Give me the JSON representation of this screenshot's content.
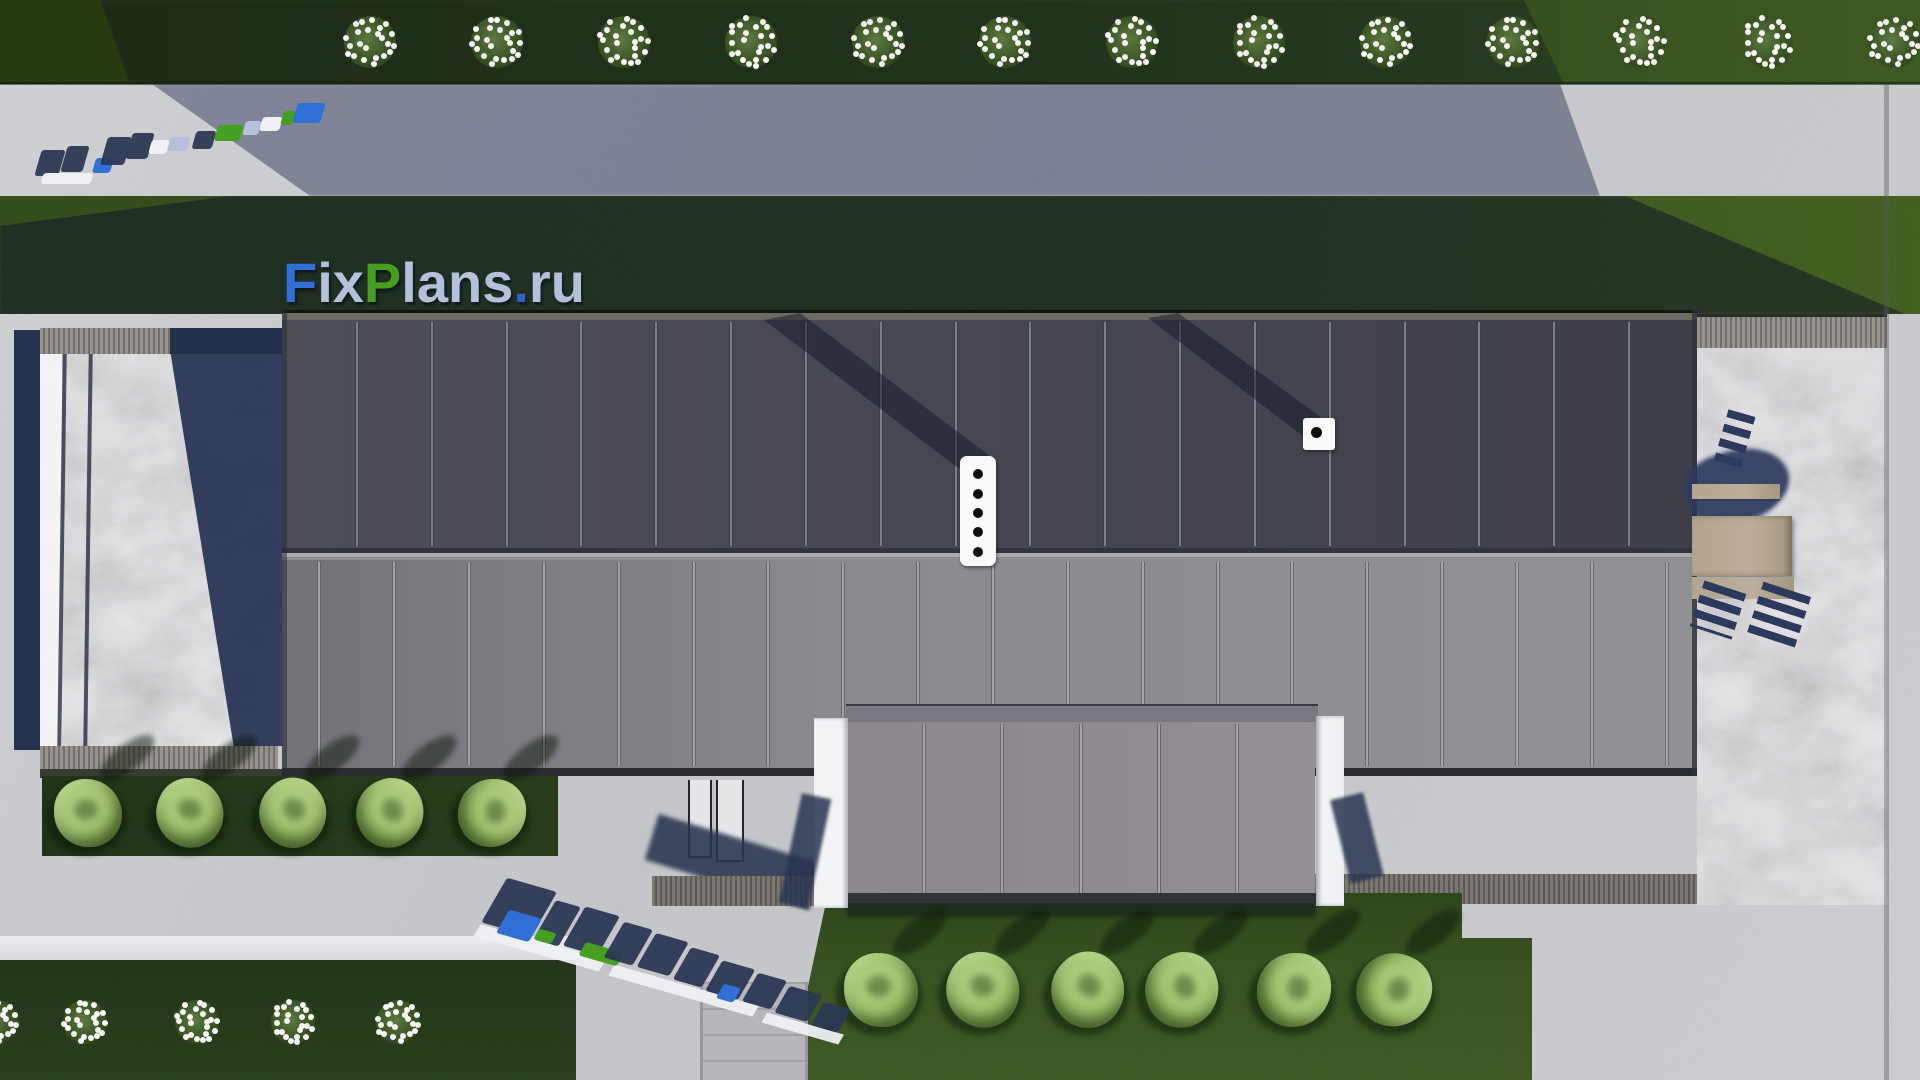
{
  "scene": {
    "description": "top-down architectural site render",
    "watermark_text": "FixPlans.ru"
  },
  "palette": {
    "pavement": "#cbccd0",
    "pavement_shadow": "rgba(52,60,94,0.5)",
    "grass_top": "#2e4418",
    "grass_field": "#3c5522",
    "grass_mid": "#35511f",
    "grass_dark_strip": "#24371a",
    "shadow_overlay": "rgba(16,22,38,0.52)",
    "roof_upper": "#45464f",
    "roof_lower": "#85848a",
    "roof_wing": "#8d898e",
    "white_wall": "#f3f4f6",
    "marble": "#e9e9ec",
    "navy": "#2c3854",
    "wood_band": "#6e6a66",
    "furniture_tan": "#b5a791",
    "flower_white": "#f6f7f5",
    "tree_foliage": "#a9c77c",
    "wm_blue": "#2f6fd6",
    "wm_green": "#45a021",
    "wm_pale": "#b6c0da",
    "wm_navy": "#2c3854",
    "wm_white": "#eef0f4"
  },
  "watermarks": {
    "main": {
      "full_text": "FixPlans.ru",
      "parts": [
        {
          "t": "F",
          "c": "#2f6fd6"
        },
        {
          "t": "ix",
          "c": "#b6c0da"
        },
        {
          "t": "P",
          "c": "#45a021"
        },
        {
          "t": "lans",
          "c": "#b6c0da"
        },
        {
          "t": ".",
          "c": "#2d62cc"
        },
        {
          "t": "ru",
          "c": "#b6c0da"
        }
      ]
    },
    "ground_top_left": {
      "text": "FixPlans.ru",
      "style": "flattened-perspective-blocks",
      "blocks": [
        {
          "x": 10,
          "y": 55,
          "w": 24,
          "h": 26,
          "c": "navy"
        },
        {
          "x": 36,
          "y": 51,
          "w": 22,
          "h": 26,
          "c": "navy"
        },
        {
          "x": 14,
          "y": 78,
          "w": 50,
          "h": 11,
          "c": "white"
        },
        {
          "x": 66,
          "y": 63,
          "w": 18,
          "h": 15,
          "c": "blue"
        },
        {
          "x": 76,
          "y": 42,
          "w": 24,
          "h": 28,
          "c": "navy"
        },
        {
          "x": 101,
          "y": 38,
          "w": 22,
          "h": 26,
          "c": "navy"
        },
        {
          "x": 122,
          "y": 45,
          "w": 18,
          "h": 14,
          "c": "white"
        },
        {
          "x": 141,
          "y": 42,
          "w": 20,
          "h": 14,
          "c": "pale"
        },
        {
          "x": 166,
          "y": 36,
          "w": 20,
          "h": 18,
          "c": "navy"
        },
        {
          "x": 188,
          "y": 30,
          "w": 26,
          "h": 16,
          "c": "green"
        },
        {
          "x": 216,
          "y": 26,
          "w": 16,
          "h": 14,
          "c": "pale"
        },
        {
          "x": 233,
          "y": 22,
          "w": 20,
          "h": 14,
          "c": "white"
        },
        {
          "x": 254,
          "y": 16,
          "w": 12,
          "h": 14,
          "c": "green"
        },
        {
          "x": 267,
          "y": 8,
          "w": 28,
          "h": 20,
          "c": "blue"
        }
      ]
    },
    "ground_bottom": {
      "text": "FixPlans.ru",
      "style": "flattened-perspective-blocks",
      "rotation_deg": 16,
      "blocks": [
        {
          "x": 8,
          "y": 6,
          "w": 52,
          "h": 50,
          "c": "navy"
        },
        {
          "x": 62,
          "y": 14,
          "w": 26,
          "h": 44,
          "c": "navy"
        },
        {
          "x": 22,
          "y": 36,
          "w": 34,
          "h": 26,
          "c": "blue"
        },
        {
          "x": 58,
          "y": 46,
          "w": 18,
          "h": 12,
          "c": "green"
        },
        {
          "x": 92,
          "y": 12,
          "w": 36,
          "h": 44,
          "c": "navy"
        },
        {
          "x": 106,
          "y": 46,
          "w": 40,
          "h": 15,
          "c": "green"
        },
        {
          "x": 134,
          "y": 16,
          "w": 30,
          "h": 40,
          "c": "navy"
        },
        {
          "x": 168,
          "y": 18,
          "w": 34,
          "h": 38,
          "c": "navy"
        },
        {
          "x": 206,
          "y": 22,
          "w": 30,
          "h": 36,
          "c": "navy"
        },
        {
          "x": 240,
          "y": 26,
          "w": 34,
          "h": 34,
          "c": "navy"
        },
        {
          "x": 250,
          "y": 48,
          "w": 18,
          "h": 16,
          "c": "blue"
        },
        {
          "x": 278,
          "y": 28,
          "w": 30,
          "h": 32,
          "c": "navy"
        },
        {
          "x": 312,
          "y": 32,
          "w": 34,
          "h": 30,
          "c": "navy"
        },
        {
          "x": 350,
          "y": 38,
          "w": 28,
          "h": 26,
          "c": "navy"
        }
      ],
      "white_bands": [
        {
          "x": 0,
          "y": 58,
          "w": 130,
          "h": 13
        },
        {
          "x": 140,
          "y": 60,
          "w": 150,
          "h": 12
        },
        {
          "x": 300,
          "y": 64,
          "w": 80,
          "h": 11
        }
      ]
    }
  },
  "building": {
    "upper_roof_panels": 19,
    "lower_roof_panels": 19,
    "wing_panels": 6,
    "chimney": {
      "vent_holes": 5,
      "holes_y": [
        474,
        494,
        513,
        532,
        552
      ],
      "cx": 978
    },
    "small_vent": {
      "holes": 1
    }
  },
  "vegetation": {
    "top_flower_bushes": {
      "count": 13,
      "xs": [
        370,
        497,
        624,
        751,
        878,
        1005,
        1132,
        1259,
        1386,
        1513,
        1640,
        1767,
        1894
      ],
      "y": 42,
      "r": 30
    },
    "bottom_flower_bushes": {
      "count": 5,
      "xs": [
        -4,
        85,
        197,
        293,
        398
      ],
      "y": 1022,
      "r": 26
    },
    "left_trees": {
      "count": 5,
      "xs": [
        88,
        190,
        293,
        390,
        492
      ],
      "y": 813,
      "r": 34
    },
    "center_trees": {
      "count": 6,
      "xs": [
        881,
        983,
        1088,
        1182,
        1294,
        1394
      ],
      "y": 990,
      "r": 37
    }
  },
  "furniture": {
    "tables": 1,
    "benches": 2,
    "chair_shadows": 3
  }
}
